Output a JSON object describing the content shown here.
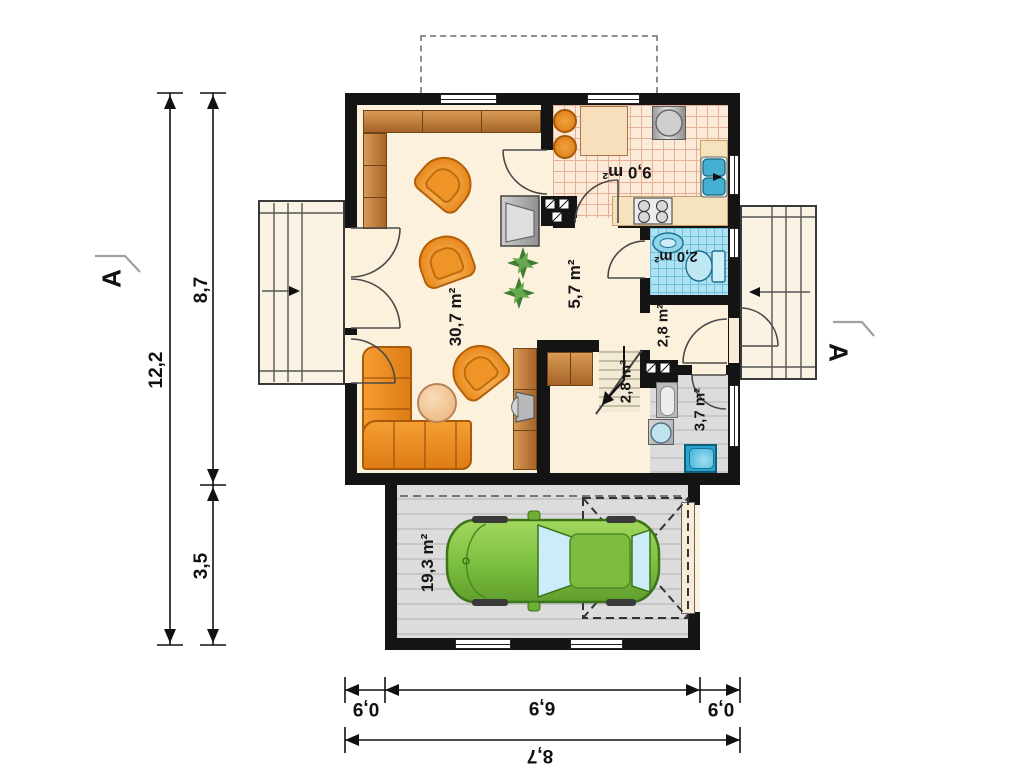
{
  "rooms": {
    "living": {
      "area": "30,7 m²"
    },
    "hall": {
      "area": "5,7 m²"
    },
    "kitchen": {
      "area": "9,0 m²"
    },
    "wc": {
      "area": "2,0 m²"
    },
    "vestibule": {
      "area": "2,8 m²"
    },
    "stairs": {
      "area": "2,8 m²"
    },
    "bathroom": {
      "area": "3,7 m²"
    },
    "garage": {
      "area": "19,3 m²"
    }
  },
  "dimensions": {
    "left": {
      "total": "12,2",
      "upper": "8,7",
      "lower": "3,5"
    },
    "bottom": {
      "left": "0,9",
      "center": "6,9",
      "right": "0,9",
      "total": "8,7"
    }
  },
  "section_markers": {
    "left": "A",
    "right": "A"
  },
  "colors": {
    "wall": "#141414",
    "floor": "#fcf1dc",
    "furniture_orange": "#ef9426",
    "wood": "#c8854a",
    "tile_blue": "#aee2f2",
    "garage_floor": "#dcdcdc",
    "car_green": "#7fc241",
    "water_blue": "#35a7c9"
  }
}
